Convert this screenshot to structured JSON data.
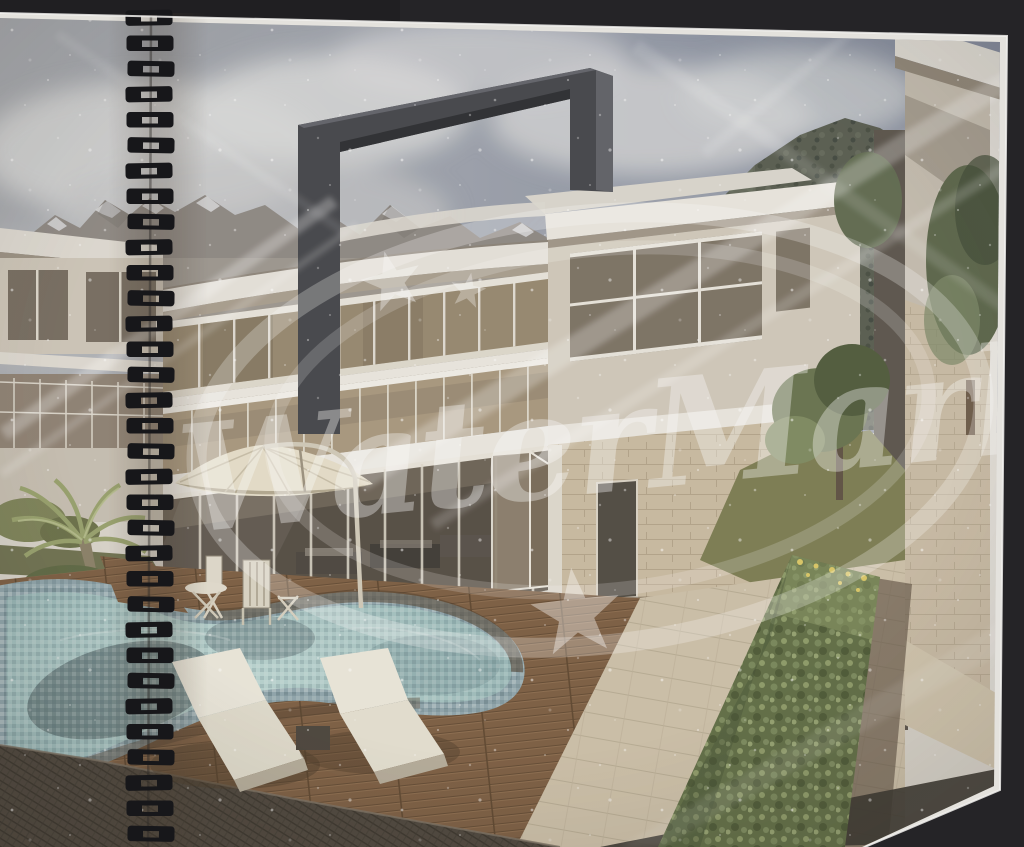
{
  "watermark": {
    "text": "WaterMark",
    "color": "#ffffff",
    "opacity": "0.36"
  },
  "binding": {
    "loop_count": 33,
    "color": "#17171a"
  },
  "colors": {
    "background": "#252427",
    "page": "#e4e2dd",
    "page_edge": "#f2f1ee",
    "sky_left": "#a6a9ae",
    "sky_right": "#7e8699",
    "cloud": "#d2d3d4",
    "mountain_rock": "#8d8883",
    "mountain_snow": "#d7d8da",
    "forest_mountain": "#575c50",
    "portal_frame": "#43454a",
    "portal_top": "#5e6067",
    "roof_white": "#e8e5de",
    "wall_cream": "#cfc8ba",
    "window_glass": "#7b7264",
    "band_glass": "#95876f",
    "balcony_glass": "#a7977e",
    "curtain_glass_top": "#6b6256",
    "curtain_glass_bottom": "#4e473e",
    "stone_wall": "#c8baa1",
    "white_column": "#ddd8cd",
    "pool_rim": "#8ea4ab",
    "pool_water": "#a2c0bf",
    "pool_shadow": "#3f4f53",
    "deck_wood": "#7b5d42",
    "deck_border": "#503e2c",
    "wicker_roof": "#4c453c",
    "paving": "#cbbfa8",
    "paving_shadow": "#5f5244",
    "hedge": "#5f6d45",
    "hedge_flower": "#d9c766",
    "lawn": "#7b7c52",
    "palm_frond": "#96a06c",
    "tree_green": "#67724f",
    "umbrella": "#e4ddc9",
    "lounger": "#e9e6da",
    "furniture_frame": "#ddd8ca"
  }
}
